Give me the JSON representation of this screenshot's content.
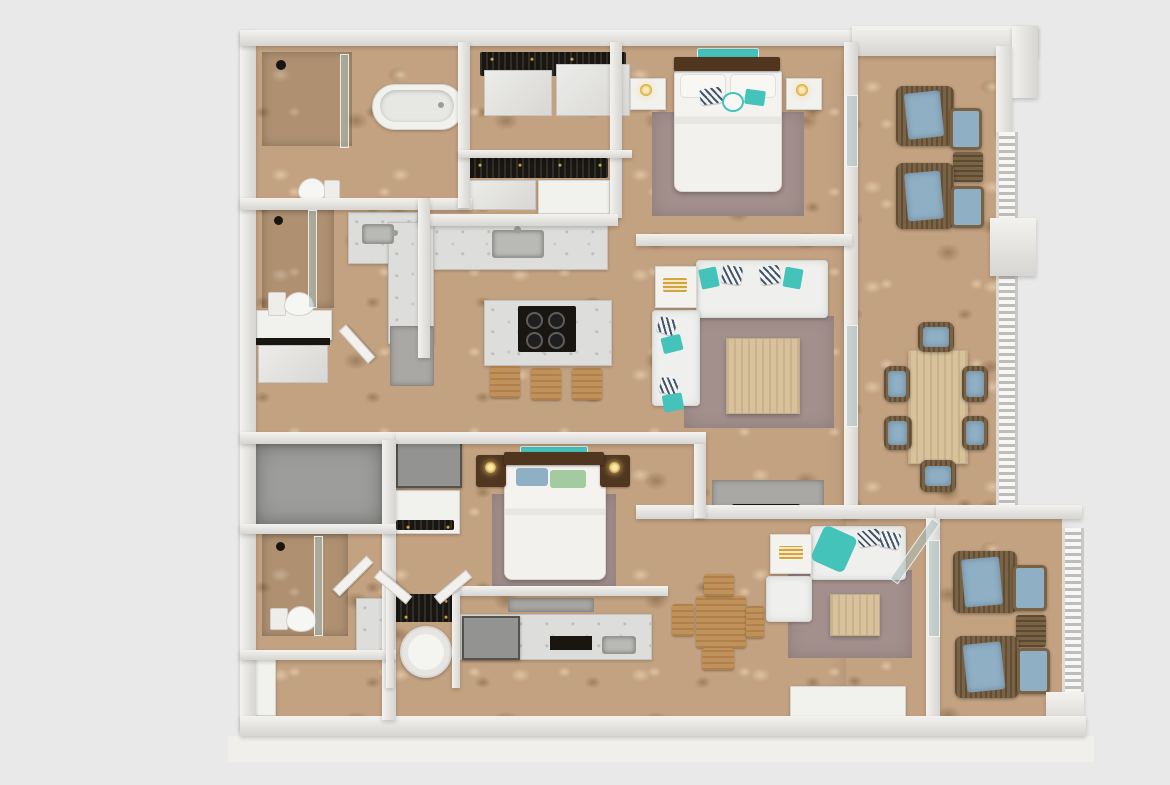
{
  "meta": {
    "description": "Top-down 3D architectural rendering of a furnished two-unit apartment floor plan on a light gray background",
    "visible_text": "none",
    "view": "orthographic top view, dollhouse style"
  },
  "palette": {
    "bg": "#e9e9e9",
    "wallFace": "#d6d5d2",
    "wallTop": "#f3f2ef",
    "floor": "#c3a281",
    "floorLight": "#ddc3a4",
    "floorDark": "#9e7f5d",
    "grayFloor": "#9d9d9b",
    "marble": "#dddddb",
    "sofa": "#eff0ee",
    "rug": "#a3908d",
    "teal": "#43c3ba",
    "blueCushion": "#8fafc5",
    "greenPillow": "#a4cba0",
    "wicker": "#7a6244",
    "woodLight": "#d7c29c",
    "woodMid": "#c09159",
    "woodDark": "#50361f",
    "dark": "#191611",
    "tvGray": "#939391",
    "lampGold": "#d1a63f"
  },
  "upper_unit": {
    "master_bathroom": {
      "items": [
        "walk-in-shower",
        "shower-glass-panel",
        "freestanding-oval-bathtub",
        "toilet"
      ]
    },
    "walk_in_closet": {
      "items": [
        "hanging-clothes",
        "sliding-doors",
        "dresser"
      ]
    },
    "master_bedroom": {
      "items": [
        "double-bed",
        "dark-wood-headboard",
        "white-pillows",
        "teal-accent-pillows",
        "striped-accent-pillows",
        "teal-wall-art",
        "nightstand-left",
        "nightstand-right",
        "table-lamps",
        "mauve-area-rug"
      ]
    },
    "second_bathroom": {
      "items": [
        "shower",
        "glass-panel",
        "toilet",
        "marble-vanity-sink",
        "linen-shelf"
      ]
    },
    "kitchen": {
      "items": [
        "l-shaped-marble-counter",
        "sink",
        "island-with-black-cooktop",
        "four-burners",
        "bar-stools-x3",
        "gray-appliance"
      ]
    },
    "living_room": {
      "items": [
        "l-shaped-sectional-sofa",
        "teal-pillows",
        "striped-pillows",
        "corner-lamp-table",
        "square-wood-coffee-table",
        "mauve-area-rug",
        "gray-tv-console"
      ]
    },
    "dining_patio": {
      "items": [
        "rectangular-wood-dining-table",
        "wicker-chairs-with-blue-cushions-x6"
      ]
    },
    "balcony": {
      "items": [
        "wicker-lounge-chairs-x2",
        "blue-cushions",
        "wicker-ottomans-x2",
        "wicker-side-table",
        "baluster-railing"
      ]
    }
  },
  "lower_unit": {
    "storage_room": {
      "items": [
        "bare-gray-concrete-floor"
      ]
    },
    "bedroom": {
      "items": [
        "double-bed",
        "dark-wood-headboard",
        "blue-pillow",
        "green-pillow",
        "teal-wall-art",
        "dark-wood-nightstands-x2",
        "table-lamps",
        "mauve-area-rug",
        "wall-tv",
        "media-cabinet-with-bottles",
        "closet-with-hanging-clothes",
        "round-white-appliance"
      ]
    },
    "bathroom": {
      "items": [
        "shower",
        "glass-panel",
        "toilet",
        "marble-vanity",
        "white-dresser"
      ]
    },
    "kitchenette": {
      "items": [
        "counter-run",
        "black-cooktop",
        "sink",
        "gray-tv",
        "wall-shelf"
      ]
    },
    "dining_area": {
      "items": [
        "square-wood-table",
        "wood-chairs-x4"
      ]
    },
    "living_room": {
      "items": [
        "white-sofa",
        "teal-throw",
        "striped-pillows",
        "white-armchair",
        "corner-tray-table",
        "wood-coffee-table",
        "mauve-area-rug",
        "tv-console"
      ]
    },
    "balcony": {
      "items": [
        "wicker-lounge-chairs-x2",
        "blue-cushions",
        "wicker-ottomans-x2",
        "wicker-side-table",
        "baluster-railing",
        "corner-column"
      ]
    }
  }
}
